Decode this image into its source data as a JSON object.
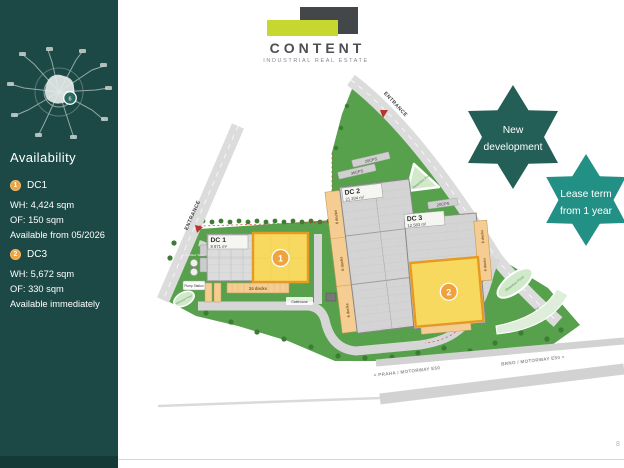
{
  "slide": {
    "page_number": "8"
  },
  "sidebar": {
    "availability": {
      "title": "Availability"
    },
    "map_marker": "6",
    "units": [
      {
        "badge": "1",
        "name": "DC1",
        "warehouse": "WH: 4,424 sqm",
        "office": "OF: 150 sqm",
        "availability": "Available from 05/2026"
      },
      {
        "badge": "2",
        "name": "DC3",
        "warehouse": "WH: 5,672 sqm",
        "office": "OF: 330 sqm",
        "availability": "Available immediately"
      }
    ]
  },
  "logo": {
    "name": "CONTENT",
    "tagline": "INDUSTRIAL REAL ESTATE"
  },
  "badges": {
    "new_development": {
      "line1": "New",
      "line2": "development"
    },
    "lease_term": {
      "line1": "Lease term",
      "line2": "from 1 year"
    }
  },
  "site_plan": {
    "entrances": {
      "left": "ENTRANCE",
      "top": "ENTRANCE"
    },
    "buildings": [
      {
        "id": "DC 1",
        "area": "8 871 m²",
        "badge": "1",
        "docks_label": "24 docks"
      },
      {
        "id": "DC 2",
        "area": "21 204 m²",
        "docks_label": "6 docks"
      },
      {
        "id": "DC 3",
        "area": "12 583 m²",
        "badge": "2",
        "docks_label": "6 docks"
      }
    ],
    "parking": {
      "p20": "20CPS",
      "p36": "36CPS",
      "p10": "10CPS"
    },
    "labels": {
      "retention_pond": "Retention Pond",
      "gatehouse": "Gatehouse",
      "pump_station": "Pump Station",
      "fire_water_tanks": "Fire Water Tanks"
    },
    "motorway": {
      "praha": "< PRAHA / MOTORWAY E50",
      "brno": "BRNO / MOTORWAY E50 >"
    }
  },
  "colors": {
    "sidebar_bg": "#1c4945",
    "site_green": "#57a14c",
    "star_dark": "#235f56",
    "star_teal": "#239085",
    "accent_orange": "#f0a23c",
    "highlight_yellow": "#f7d95f",
    "highlight_border": "#e8991f",
    "logo_lime": "#c6d72f",
    "logo_charcoal": "#43474a",
    "dock_tan": "#f5cd92",
    "pond_green": "#cfe9c9",
    "road_gray": "#dcdcdc",
    "building_gray": "#d4d4d4"
  }
}
